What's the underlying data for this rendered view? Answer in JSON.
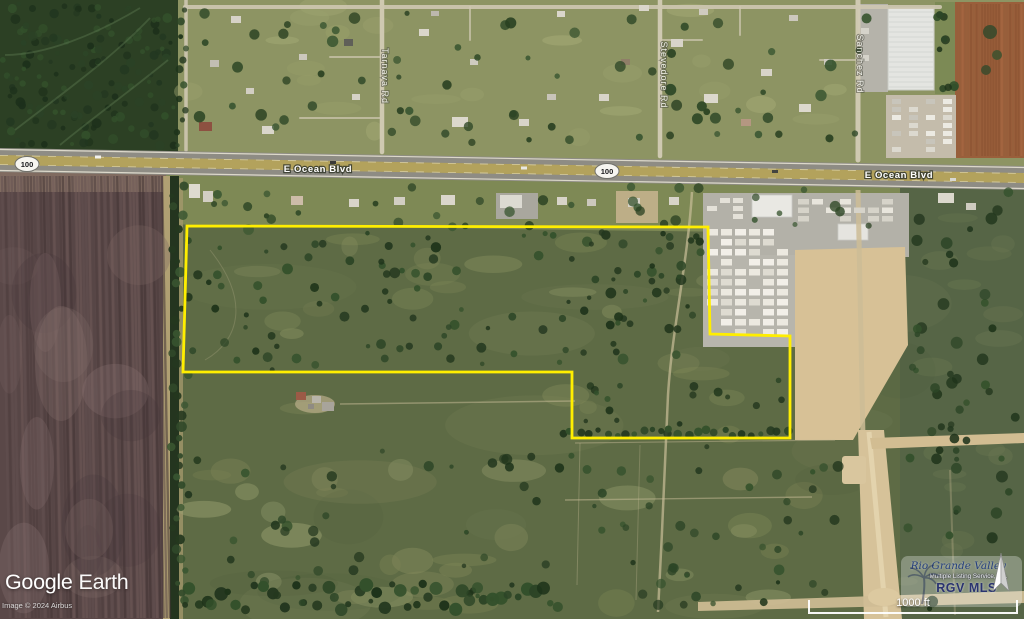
{
  "map": {
    "route_shield": "100",
    "road_name": "E Ocean Blvd",
    "streets": [
      {
        "label": "Tarnava Rd"
      },
      {
        "label": "Stevedore Rd"
      },
      {
        "label": "Sanchez Rd"
      }
    ]
  },
  "parcel": {
    "outline_points": "187,226 708,227 710,334 790,336 790,438 572,438 572,372 183,372",
    "boundary_color": "#ffee00"
  },
  "overlay": {
    "logo": {
      "brand": "Google",
      "product": "Earth"
    },
    "copyright": "Image © 2024 Airbus",
    "watermark": {
      "org_script": "Rio Grande Valley",
      "org_sub": "Multiple Listing Service, Inc.",
      "org_abbr": "RGV MLS"
    },
    "scale_bar": {
      "label": "1000 ft"
    }
  },
  "colors": {
    "parcel_boundary": "#ffee00",
    "highway_center": "#b3a25c",
    "highway_pavement": "#8e8c84",
    "grass_field": "#5e6b45",
    "plowed_field": "#5a4848",
    "sand_road": "#d6c299",
    "rgv_navy": "#2a3370",
    "label_white": "#ffffff"
  }
}
